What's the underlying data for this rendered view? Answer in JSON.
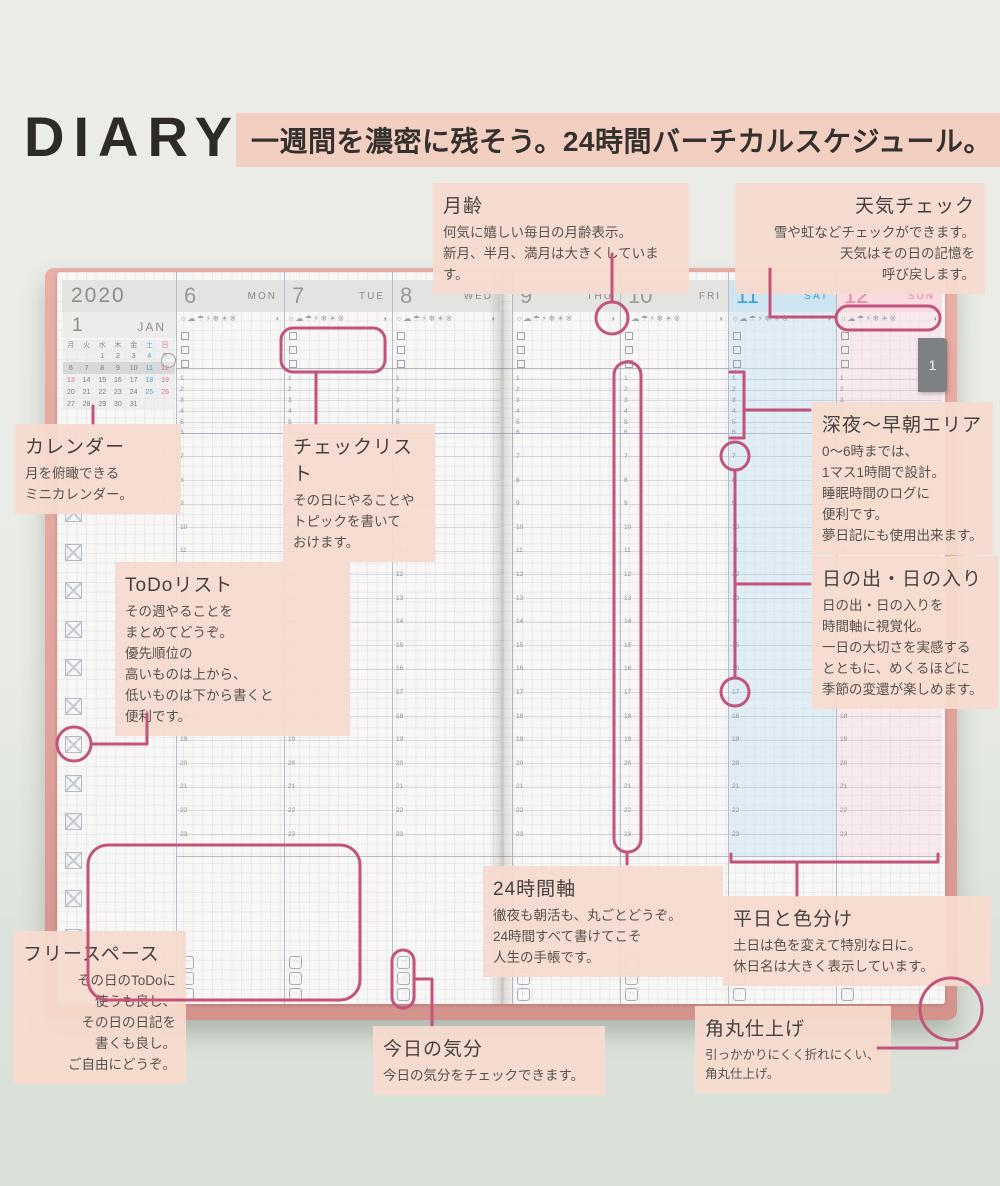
{
  "header": {
    "brand": "DIARY",
    "tagline": "一週間を濃密に残そう。24時間バーチカルスケジュール。"
  },
  "colors": {
    "callout_accent": "#c2537a",
    "band_bg": "#f3cfc2",
    "note_bg": "#f7dbce",
    "cover_pink": "#e3a69e",
    "weekday_header_bg": "#e4e3e1",
    "weekday_text": "#9b9997",
    "saturday_text": "#3f9fd8",
    "saturday_header_bg": "#cfe4f1",
    "saturday_tint": "rgba(201,227,243,0.5)",
    "sunday_text": "#e8849e",
    "sunday_header_bg": "#f9dbe2",
    "sunday_tint": "rgba(249,218,227,0.45)"
  },
  "book": {
    "year": "2020",
    "month_num": "1",
    "month_name": "JAN",
    "tab_label": "1",
    "weather_icons": "○☁☂⚡❄☀※",
    "moon_icon": "◑",
    "mood_icon_count": 3,
    "mini_calendar": {
      "weekday_header": [
        "月",
        "火",
        "水",
        "木",
        "金",
        "土",
        "日"
      ],
      "weeks": [
        [
          "",
          "",
          "1",
          "2",
          "3",
          "4",
          "5"
        ],
        [
          "6",
          "7",
          "8",
          "9",
          "10",
          "11",
          "12"
        ],
        [
          "13",
          "14",
          "15",
          "16",
          "17",
          "18",
          "19"
        ],
        [
          "20",
          "21",
          "22",
          "23",
          "24",
          "25",
          "26"
        ],
        [
          "27",
          "28",
          "29",
          "30",
          "31",
          "",
          ""
        ]
      ],
      "saturday_dates": [
        "4",
        "11",
        "18",
        "25"
      ],
      "holiday_dates": [
        "5",
        "12",
        "13",
        "19",
        "26"
      ],
      "current_week_row": 1
    },
    "days": [
      {
        "num": "6",
        "name": "MON",
        "type": "weekday"
      },
      {
        "num": "7",
        "name": "TUE",
        "type": "weekday"
      },
      {
        "num": "8",
        "name": "WED",
        "type": "weekday"
      },
      {
        "num": "9",
        "name": "THU",
        "type": "weekday"
      },
      {
        "num": "10",
        "name": "FRI",
        "type": "weekday"
      },
      {
        "num": "11",
        "name": "SAT",
        "type": "saturday"
      },
      {
        "num": "12",
        "name": "SUN",
        "type": "sunday"
      }
    ],
    "time_hours": [
      1,
      2,
      3,
      4,
      5,
      6,
      7,
      8,
      9,
      10,
      11,
      12,
      13,
      14,
      15,
      16,
      17,
      18,
      19,
      20,
      21,
      22,
      23
    ]
  },
  "annotations": {
    "moon_age": {
      "title": "月齢",
      "body": "何気に嬉しい毎日の月齢表示。\n新月、半月、満月は大きくしています。"
    },
    "weather_check": {
      "title": "天気チェック",
      "body": "雪や虹などチェックができます。\n天気はその日の記憶を\n呼び戻します。"
    },
    "calendar": {
      "title": "カレンダー",
      "body": "月を俯瞰できる\nミニカレンダー。"
    },
    "checklist": {
      "title": "チェックリスト",
      "body": "その日にやることや\nトピックを書いて\nおけます。"
    },
    "todo_list": {
      "title": "ToDoリスト",
      "body": "その週やることを\nまとめてどうぞ。\n優先順位の\n高いものは上から、\n低いものは下から書くと\n便利です。"
    },
    "midnight_area": {
      "title": "深夜〜早朝エリア",
      "body": "0〜6時までは、\n1マス1時間で設計。\n睡眠時間のログに\n便利です。\n夢日記にも使用出来ます。"
    },
    "sunrise_sunset": {
      "title": "日の出・日の入り",
      "body": "日の出・日の入りを\n時間軸に視覚化。\n一日の大切さを実感する\nとともに、めくるほどに\n季節の変還が楽しめます。"
    },
    "axis_24h": {
      "title": "24時間軸",
      "body": "徹夜も朝活も、丸ごとどうぞ。\n24時間すべて書けてこそ\n人生の手帳です。"
    },
    "weekday_colors": {
      "title": "平日と色分け",
      "body": "土日は色を変えて特別な日に。\n休日名は大きく表示しています。"
    },
    "free_space": {
      "title": "フリースペース",
      "body": "その日のToDoに\n使うも良し、\nその日の日記を\n書くも良し。\nご自由にどうぞ。"
    },
    "today_mood": {
      "title": "今日の気分",
      "body": "今日の気分をチェックできます。"
    },
    "rounded_corners": {
      "title": "角丸仕上げ",
      "body": "引っかかりにくく折れにくい、\n角丸仕上げ。"
    }
  }
}
